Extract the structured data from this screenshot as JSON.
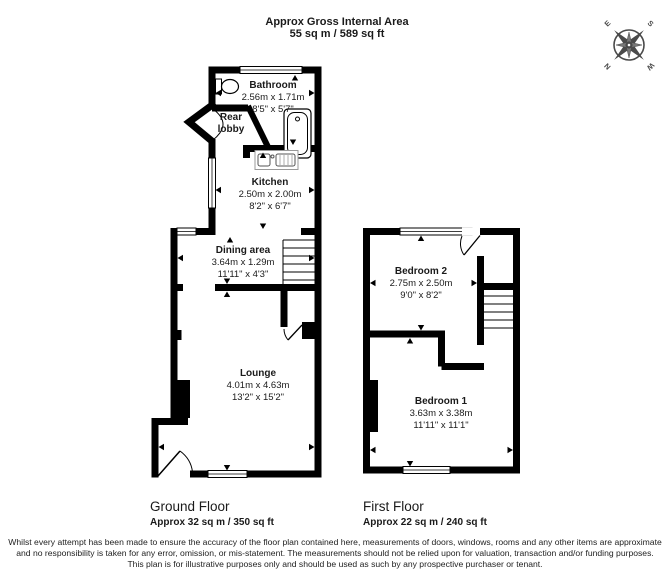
{
  "header": {
    "title": "Approx Gross Internal Area",
    "area": "55 sq m / 589 sq ft"
  },
  "compass": {
    "n": "N",
    "e": "E",
    "s": "S",
    "w": "W"
  },
  "rooms": {
    "bathroom": {
      "name": "Bathroom",
      "metric": "2.56m x 1.71m",
      "imperial": "8'5\" x 5'7\""
    },
    "rear_lobby": {
      "name": "Rear lobby"
    },
    "kitchen": {
      "name": "Kitchen",
      "metric": "2.50m x 2.00m",
      "imperial": "8'2\" x 6'7\""
    },
    "dining": {
      "name": "Dining area",
      "metric": "3.64m x 1.29m",
      "imperial": "11'11\" x 4'3\""
    },
    "lounge": {
      "name": "Lounge",
      "metric": "4.01m x 4.63m",
      "imperial": "13'2\" x 15'2\""
    },
    "bedroom2": {
      "name": "Bedroom 2",
      "metric": "2.75m x 2.50m",
      "imperial": "9'0\" x 8'2\""
    },
    "bedroom1": {
      "name": "Bedroom 1",
      "metric": "3.63m x 3.38m",
      "imperial": "11'11\" x 11'1\""
    }
  },
  "floors": {
    "ground": {
      "label": "Ground Floor",
      "area": "Approx 32 sq m / 350 sq ft"
    },
    "first": {
      "label": "First Floor",
      "area": "Approx 22 sq m / 240 sq ft"
    }
  },
  "disclaimer": "Whilst every attempt has been made to ensure the accuracy of the floor plan contained here, measurements of doors, windows, rooms and any other items are approximate and no responsibility is taken for any error, omission, or mis-statement. The measurements should not be relied upon for valuation, transaction and/or funding purposes. This plan is for illustrative purposes only and should be used as such by any prospective purchaser or tenant.",
  "colors": {
    "wall": "#000000",
    "compass": "#4a4a4a"
  }
}
